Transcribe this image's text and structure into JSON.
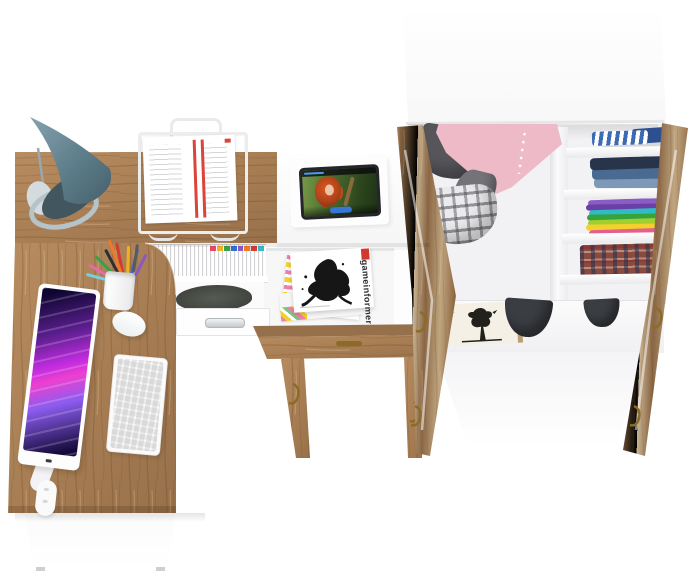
{
  "scene": {
    "description": "3D render, top-down view of a kids-room furniture set: corner computer desk, side table with magazine rack, and open wardrobe filled with clothes",
    "background": "#ffffff"
  },
  "palette": {
    "wood": "#a87e54",
    "wood_dark": "#8a6441",
    "white_furniture": "#ffffff",
    "brass": "#8a6c28"
  },
  "desk": {
    "lamp": {
      "shade_color": "#5d7d8a",
      "base_color": "#b6c3c9"
    },
    "paper_tray": {
      "frame_color": "#eceeee",
      "paper_color": "#ffffff",
      "accent_color": "#d9453a"
    },
    "monitor": {
      "bezel_color": "#fdfdfe",
      "wallpaper_colors": [
        "#140a38",
        "#5b1e8e",
        "#e03ddd",
        "#8c5cf0"
      ]
    },
    "keyboard": {
      "color": "#fbfbfc"
    },
    "mouse": {
      "color": "#ffffff"
    },
    "pencil_cup": {
      "cup_color": "#ffffff",
      "pen_colors": [
        "#2f2f33",
        "#d33b30",
        "#f2b01f",
        "#3aa04a",
        "#2f6fd0",
        "#e86aa8",
        "#8a57c9",
        "#f07828",
        "#77d0e0",
        "#5a5a5e"
      ]
    },
    "shelf_binders": {
      "color": "#ffffff",
      "tab_colors": [
        "#e8486b",
        "#f2b01f",
        "#3aa04a",
        "#2f6fd0",
        "#8a57c9",
        "#f07828",
        "#d33b30",
        "#35b8c9"
      ]
    },
    "backpack_color": "#474b44",
    "drawer": {
      "color": "#ffffff",
      "handle_color": "#c6cacd"
    }
  },
  "hutch": {
    "tablet": {
      "bezel_color": "#24262b",
      "video_still": "red-haired girl in green forest",
      "progress_color": "#4a9af5",
      "button_color": "#3577d8"
    }
  },
  "magazine_rack": {
    "top_magazine_title": "gameinformer",
    "cover_color": "#ffffff",
    "ink_art_color": "#161616",
    "label_color": "#d2372e",
    "edge_colors": [
      "#f2d12e",
      "#ef7fae"
    ]
  },
  "side_table": {
    "handle_color": "#8a6c28",
    "hook_color": "#8a6c28"
  },
  "wardrobe": {
    "hanging_clothes": [
      {
        "name": "gray-jacket",
        "color": "#55555a"
      },
      {
        "name": "pink-dress",
        "color": "#eebac8"
      },
      {
        "name": "gray-trousers",
        "color": "#737378"
      },
      {
        "name": "plaid-bag",
        "color": "#ebebed"
      }
    ],
    "shelf_stacks": [
      {
        "name": "striped-shirts",
        "colors": [
          "#3d6ab5",
          "#ffffff",
          "#2e4f8f"
        ]
      },
      {
        "name": "jeans",
        "colors": [
          "#273449",
          "#4a6a92",
          "#7e99b8"
        ]
      },
      {
        "name": "bright-tees",
        "colors": [
          "#8a5cc4",
          "#6a3fa8",
          "#2fbdc4",
          "#37a33c",
          "#9fd02f",
          "#f2d12e",
          "#e45f8a"
        ]
      },
      {
        "name": "plaid-shirts",
        "colors": [
          "#8a4a3c",
          "#2e3d5c",
          "#c9c2b8"
        ]
      }
    ],
    "bottom_items": [
      {
        "name": "framed-tree-picture",
        "frame_color": "#bb9f72"
      },
      {
        "name": "winter-hats",
        "color": "#3a3d42"
      }
    ]
  }
}
